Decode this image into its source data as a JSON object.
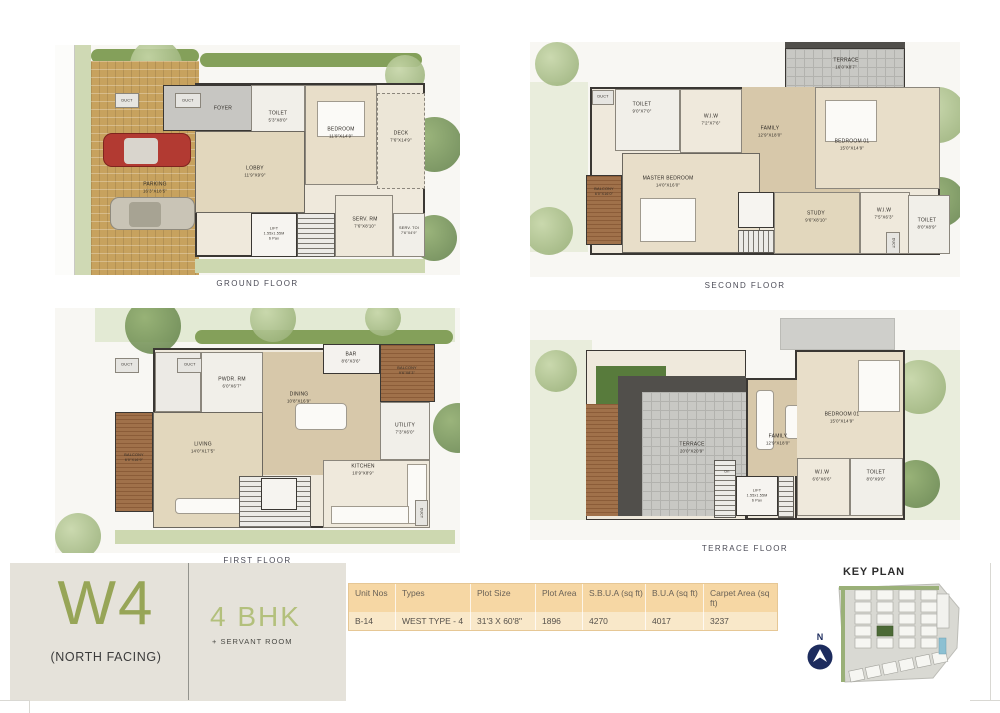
{
  "captions": {
    "ground": "GROUND FLOOR",
    "second": "SECOND FLOOR",
    "first": "FIRST FLOOR",
    "terrace": "TERRACE FLOOR"
  },
  "floors": {
    "ground": {
      "rooms": {
        "duct1": {
          "label": "DUCT",
          "dims": ""
        },
        "duct2": {
          "label": "DUCT",
          "dims": ""
        },
        "foyer": {
          "label": "FOYER",
          "dims": ""
        },
        "toilet": {
          "label": "TOILET",
          "dims": "5'3\"X8'0\""
        },
        "bedroom": {
          "label": "BEDROOM",
          "dims": "11'9\"X14'9\""
        },
        "deck": {
          "label": "DECK",
          "dims": "7'6\"X14'9\""
        },
        "lobby": {
          "label": "LOBBY",
          "dims": "11'9\"X9'9\""
        },
        "lift": {
          "label": "LIFT",
          "dims": "1.55x1.55M",
          "cap": "6 Pax"
        },
        "servrm": {
          "label": "SERV. RM",
          "dims": "7'6\"X8'10\""
        },
        "servtoi": {
          "label": "SERV. TOI",
          "dims": "7'6\"X4'9\""
        },
        "parking": {
          "label": "PARKING",
          "dims": "16'3\"X18'5\""
        }
      }
    },
    "second": {
      "rooms": {
        "terrace": {
          "label": "TERRACE",
          "dims": "16'0\"X8'7\""
        },
        "duct1": {
          "label": "DUCT",
          "dims": ""
        },
        "toilet1": {
          "label": "TOILET",
          "dims": "9'0\"X7'0\""
        },
        "wiw1": {
          "label": "W.I.W",
          "dims": "7'2\"X7'6\""
        },
        "family": {
          "label": "FAMILY",
          "dims": "12'9\"X18'0\""
        },
        "balcony": {
          "label": "BALCONY",
          "dims": "6'0\"X16'0\""
        },
        "master": {
          "label": "MASTER BEDROOM",
          "dims": "14'0\"X16'0\""
        },
        "bedroom01": {
          "label": "BEDROOM 01",
          "dims": "15'0\"X14'9\""
        },
        "study": {
          "label": "STUDY",
          "dims": "9'6\"X8'10\""
        },
        "wiw2": {
          "label": "W.I.W",
          "dims": "7'5\"X6'3\""
        },
        "toilet2": {
          "label": "TOILET",
          "dims": "8'0\"X8'9\""
        },
        "duct2": {
          "label": "DUCT",
          "dims": ""
        }
      }
    },
    "first": {
      "rooms": {
        "duct1": {
          "label": "DUCT",
          "dims": ""
        },
        "duct2": {
          "label": "DUCT",
          "dims": ""
        },
        "duct3": {
          "label": "DUCT",
          "dims": ""
        },
        "pwdr": {
          "label": "PWDR. RM",
          "dims": "6'0\"X6'7\""
        },
        "bar": {
          "label": "BAR",
          "dims": "8'6\"X3'6\""
        },
        "balcony2": {
          "label": "BALCONY",
          "dims": "9'6\"X8'3\""
        },
        "dining": {
          "label": "DINING",
          "dims": "10'8\"X16'9\""
        },
        "utility": {
          "label": "UTILITY",
          "dims": "7'3\"X6'0\""
        },
        "kitchen": {
          "label": "KITCHEN",
          "dims": "10'9\"X8'9\""
        },
        "living": {
          "label": "LIVING",
          "dims": "14'0\"X17'5\""
        },
        "balcony1": {
          "label": "BALCONY",
          "dims": "6'0\"X16'9\""
        }
      }
    },
    "terrace": {
      "rooms": {
        "terrace": {
          "label": "TERRACE",
          "dims": "20'0\"X20'9\""
        },
        "family": {
          "label": "FAMILY",
          "dims": "12'9\"X18'0\""
        },
        "lift": {
          "label": "LIFT",
          "dims": "1.55x1.55M",
          "cap": "6 Pax"
        },
        "dn": {
          "label": "Dn",
          "dims": ""
        },
        "bedroom01": {
          "label": "BEDROOM 01",
          "dims": "15'0\"X14'9\""
        },
        "wiw": {
          "label": "W.I.W",
          "dims": "6'6\"X6'6\""
        },
        "toilet": {
          "label": "TOILET",
          "dims": "8'0\"X9'0\""
        }
      }
    }
  },
  "footer": {
    "unit_code": "W4",
    "facing": "(NORTH FACING)",
    "unit_type": "4 BHK",
    "unit_type_sub": "+ SERVANT ROOM",
    "key_plan_title": "KEY PLAN",
    "compass_label": "N",
    "table": {
      "headers": [
        "Unit Nos",
        "Types",
        "Plot Size",
        "Plot Area",
        "S.B.U.A (sq ft)",
        "B.U.A (sq ft)",
        "Carpet Area (sq ft)"
      ],
      "rows": [
        [
          "B-14",
          "WEST TYPE - 4",
          "31'3 X 60'8\"",
          "1896",
          "4270",
          "4017",
          "3237"
        ]
      ]
    }
  },
  "colors": {
    "accent_green": "#97a557",
    "accent_green_light": "#b3c07c",
    "table_header_bg": "#f6d7a4",
    "compass_navy": "#1d2c5e",
    "panel_beige": "#e5e2da"
  }
}
